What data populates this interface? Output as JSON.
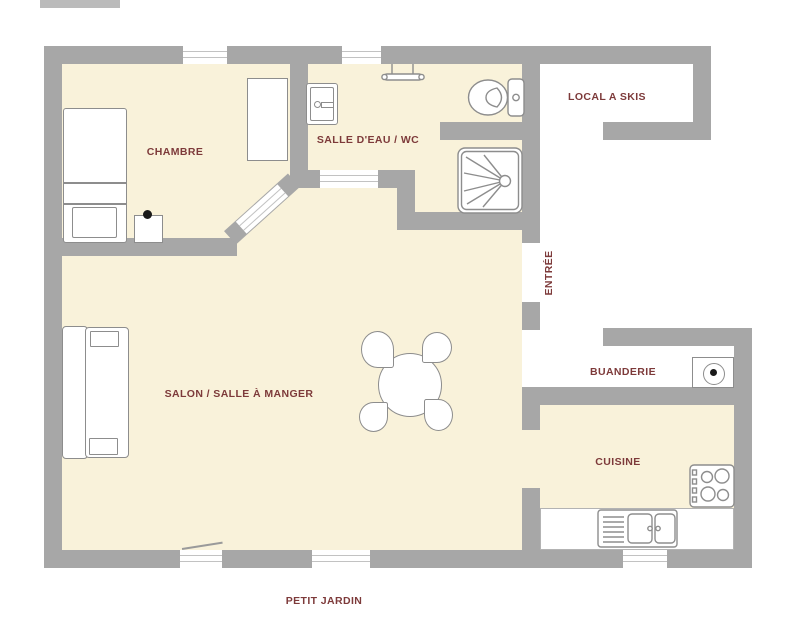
{
  "canvas": {
    "width": 800,
    "height": 630,
    "type": "floor-plan"
  },
  "labels": {
    "chambre": "CHAMBRE",
    "salle_eau": "SALLE D'EAU / WC",
    "local_skis": "LOCAL A SKIS",
    "entree": "ENTRÉE",
    "salon": "SALON / SALLE À MANGER",
    "buanderie": "BUANDERIE",
    "cuisine": "CUISINE",
    "jardin": "PETIT JARDIN"
  },
  "rooms": [
    {
      "id": "chambre",
      "label": "CHAMBRE",
      "furniture": [
        "bed",
        "nightstand-lamp",
        "wardrobe"
      ]
    },
    {
      "id": "salle_eau",
      "label": "SALLE D'EAU / WC",
      "furniture": [
        "cabinet-door",
        "towel-rail",
        "toilet",
        "shower"
      ]
    },
    {
      "id": "local_skis",
      "label": "LOCAL A SKIS",
      "furniture": []
    },
    {
      "id": "entree",
      "label": "ENTRÉE",
      "furniture": []
    },
    {
      "id": "salon",
      "label": "SALON / SALLE À MANGER",
      "furniture": [
        "sofa",
        "dining-table",
        "four-chairs"
      ]
    },
    {
      "id": "buanderie",
      "label": "BUANDERIE",
      "furniture": [
        "washing-machine"
      ]
    },
    {
      "id": "cuisine",
      "label": "CUISINE",
      "furniture": [
        "stove",
        "counter",
        "double-sink"
      ]
    }
  ],
  "icons": [
    "bed-icon",
    "wardrobe-icon",
    "nightstand-lamp-icon",
    "cabinet-door-icon",
    "towel-rail-icon",
    "toilet-icon",
    "shower-icon",
    "sofa-icon",
    "dining-table-icon",
    "chair-icon",
    "washing-machine-icon",
    "stove-icon",
    "sink-icon",
    "window-icon",
    "door-opening-icon"
  ],
  "colors": {
    "wall": "#a7a7a7",
    "floor": "#f9f2da",
    "outside": "#ffffff",
    "label": "#7d3a3a",
    "outline": "#8d8d8d",
    "furn": "#ffffff",
    "lamp": "#1a1a1a",
    "line": "#c2c2c2"
  }
}
